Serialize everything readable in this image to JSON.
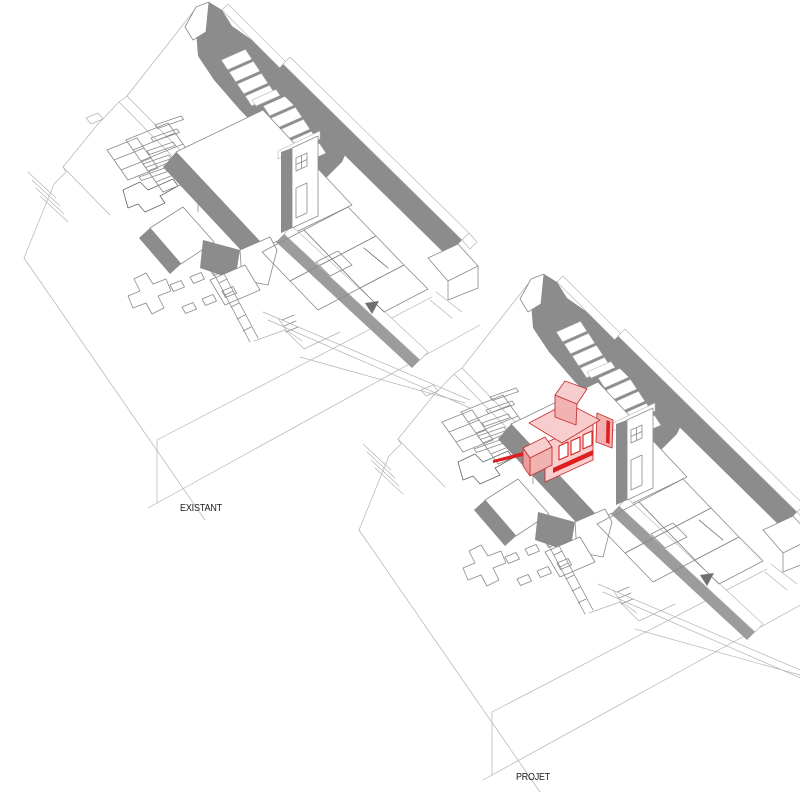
{
  "drawings": [
    {
      "id": "existant",
      "label": "EXISTANT",
      "highlight": false
    },
    {
      "id": "projet",
      "label": "PROJET",
      "highlight": true
    }
  ],
  "highlight_meaning": "new addition volume shown in pink with red edges on the PROJET view",
  "colors": {
    "wall_shade": "#8c8c8c",
    "wall_shade_2": "#9c9c9c",
    "line": "#8a8a8a",
    "faint_line": "#b3b3b3",
    "addition_fill": "#f8cdcd",
    "addition_shade": "#f2b2b2",
    "addition_dark": "#e89c9c",
    "addition_line": "#c63232",
    "addition_accent": "#dd1f1f",
    "label_color": "#1a1a1a",
    "marker": "#6f6f6f",
    "background": "#ffffff"
  }
}
